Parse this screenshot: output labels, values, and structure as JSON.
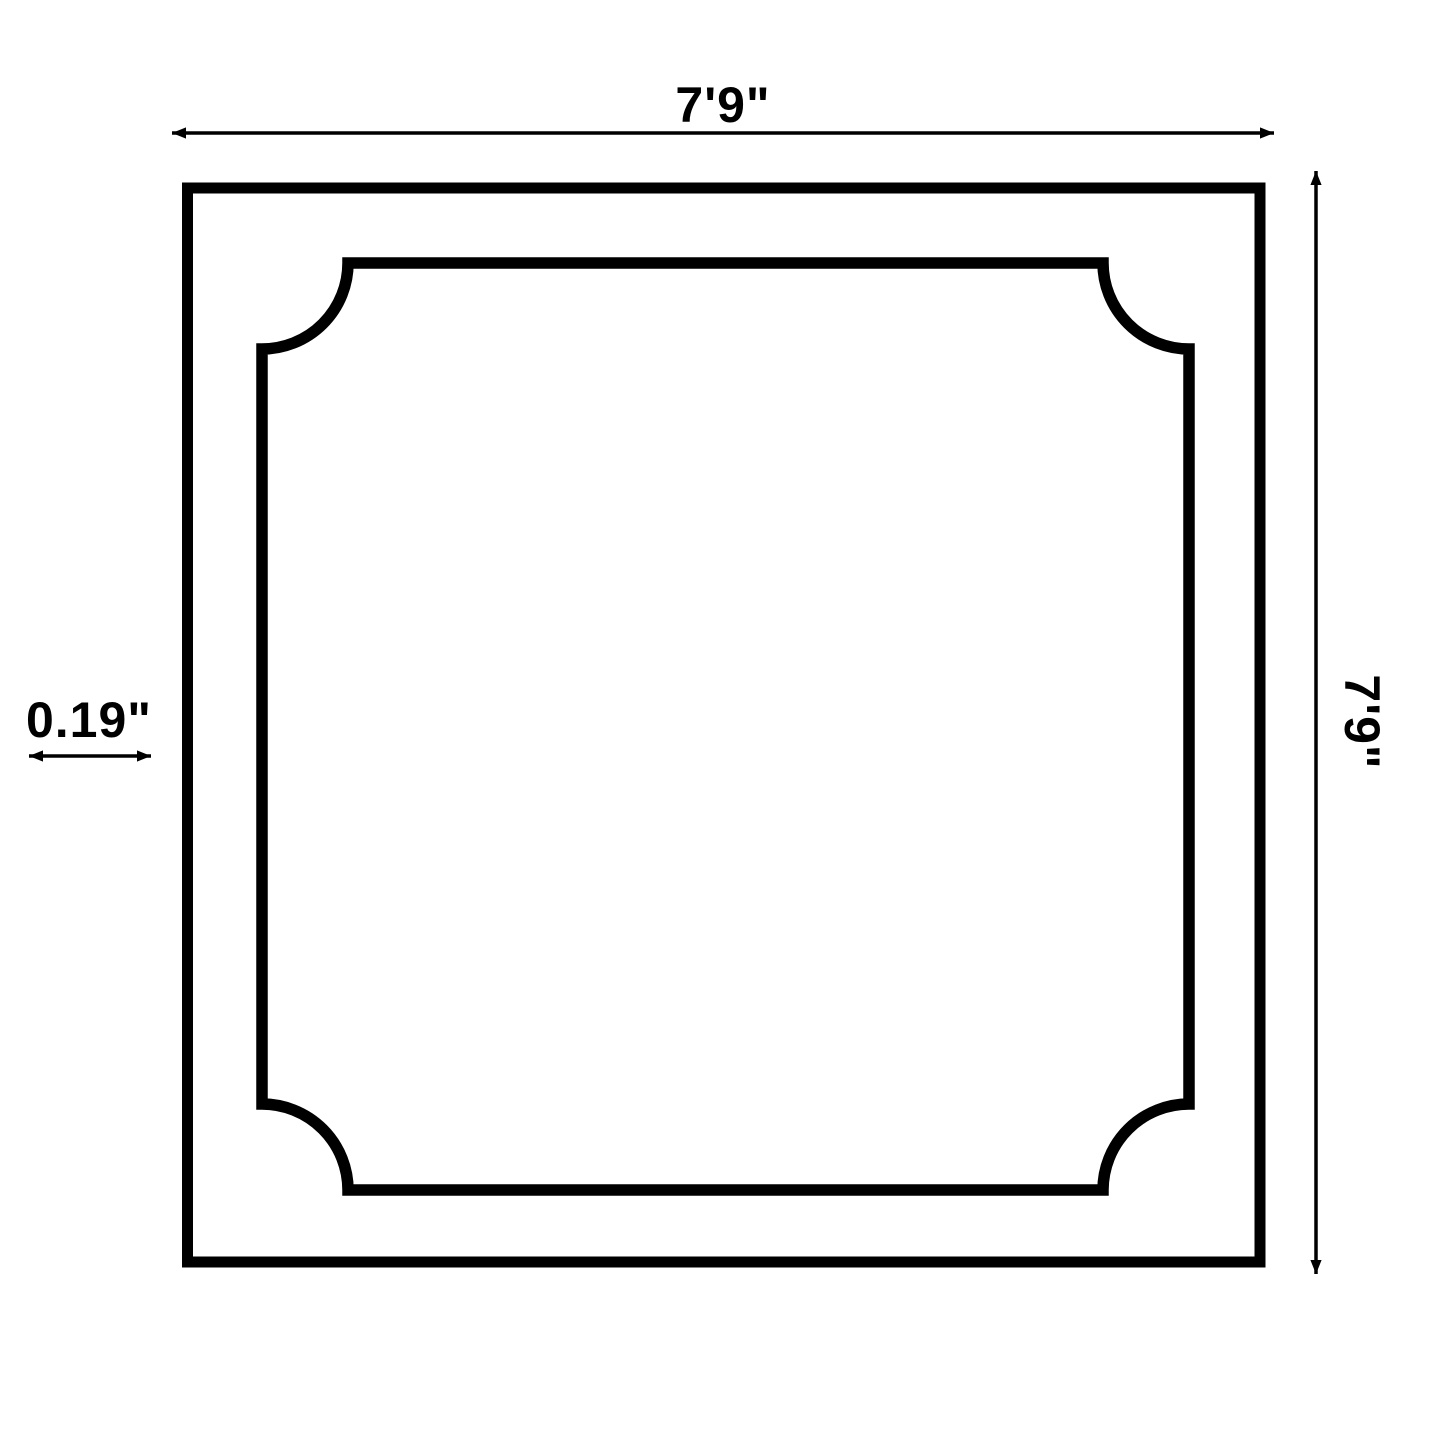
{
  "diagram": {
    "background_color": "#ffffff",
    "line_color": "#000000",
    "shape": {
      "outer_outline": "square",
      "inner_outline": "square-with-concave-scalloped-corners"
    },
    "dimensions": {
      "width": {
        "label": "7'9\""
      },
      "height": {
        "label": "7'9\""
      },
      "thickness": {
        "label": "0.19\""
      }
    }
  }
}
